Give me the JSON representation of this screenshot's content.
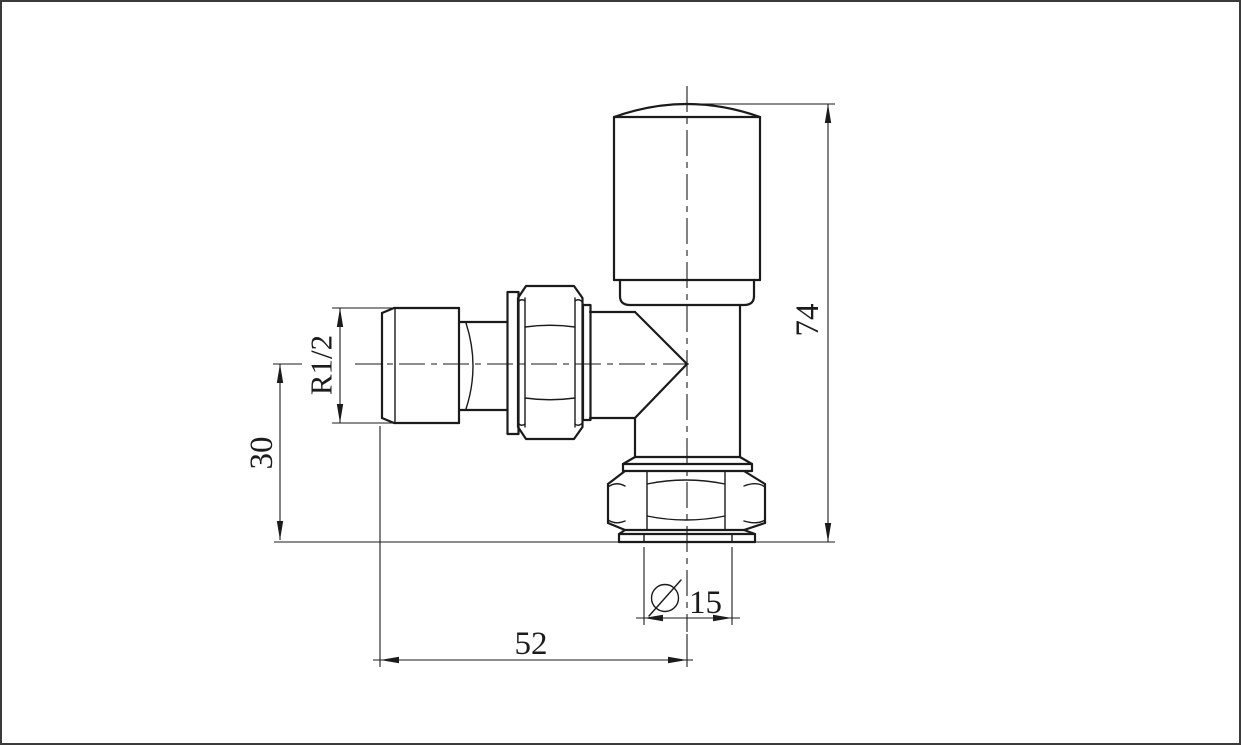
{
  "page": {
    "background_color": "#ffffff",
    "frame_border_color": "#3a3a3a",
    "line_color": "#1b1b1b"
  },
  "drawing": {
    "type": "technical-drawing",
    "dimensions": {
      "total_height": {
        "label": "74"
      },
      "inlet_center_height": {
        "label": "30"
      },
      "thread_size": {
        "label": "R1/2"
      },
      "center_to_inlet_width": {
        "label": "52"
      },
      "pipe_diameter": {
        "symbol": "Ø",
        "label": "15"
      }
    }
  }
}
